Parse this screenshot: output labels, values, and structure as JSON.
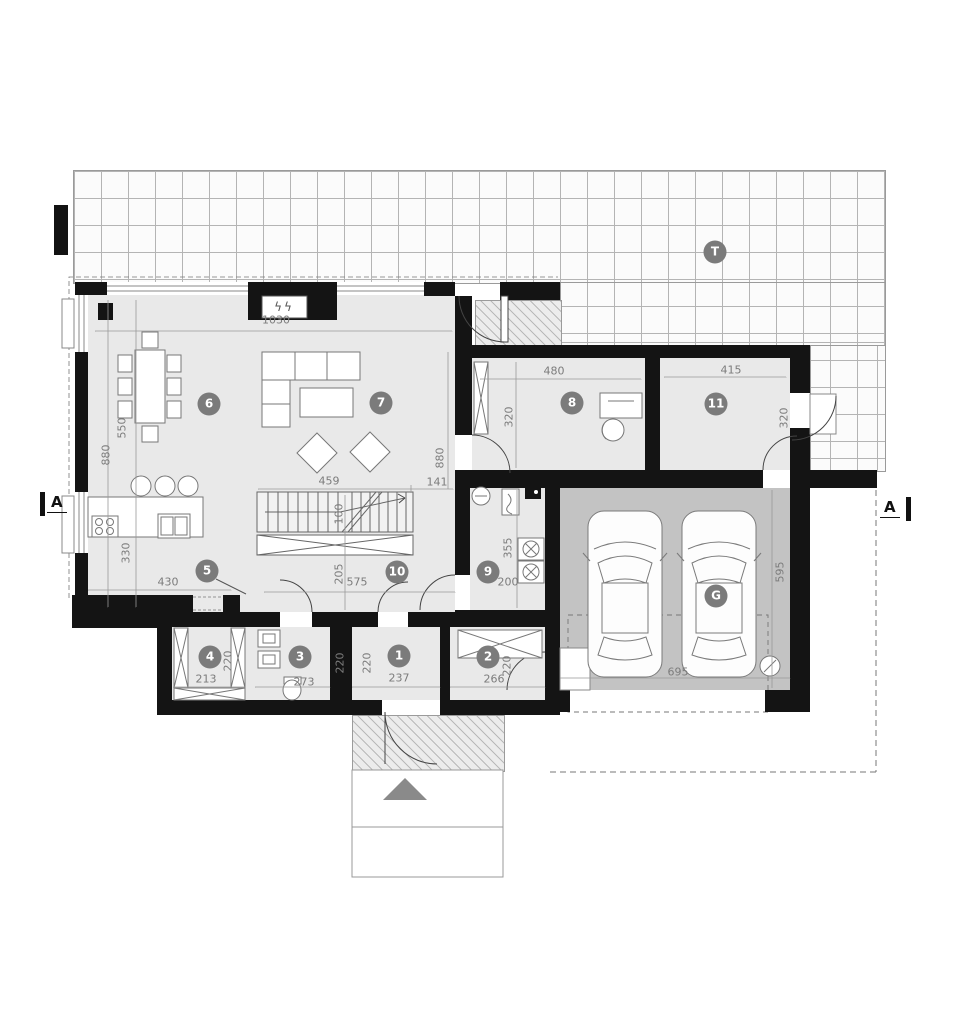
{
  "plan": {
    "section_marker": "A",
    "terrace_label": "T",
    "garage_label": "G",
    "fireplace_icon_glyph": "ϟϟ"
  },
  "rooms": [
    {
      "number": "1",
      "x": 399,
      "y": 656
    },
    {
      "number": "2",
      "x": 488,
      "y": 657
    },
    {
      "number": "3",
      "x": 300,
      "y": 657
    },
    {
      "number": "4",
      "x": 210,
      "y": 657
    },
    {
      "number": "5",
      "x": 207,
      "y": 571
    },
    {
      "number": "6",
      "x": 209,
      "y": 404
    },
    {
      "number": "7",
      "x": 381,
      "y": 403
    },
    {
      "number": "8",
      "x": 572,
      "y": 403
    },
    {
      "number": "9",
      "x": 488,
      "y": 572
    },
    {
      "number": "10",
      "x": 397,
      "y": 572
    },
    {
      "number": "11",
      "x": 716,
      "y": 404
    }
  ],
  "dimensions": [
    {
      "text": "1030",
      "x": 276,
      "y": 320,
      "rot": 0
    },
    {
      "text": "550",
      "x": 122,
      "y": 428,
      "rot": 1
    },
    {
      "text": "880",
      "x": 106,
      "y": 455,
      "rot": 1
    },
    {
      "text": "880",
      "x": 440,
      "y": 458,
      "rot": 1
    },
    {
      "text": "459",
      "x": 329,
      "y": 481,
      "rot": 0
    },
    {
      "text": "141",
      "x": 437,
      "y": 482,
      "rot": 0
    },
    {
      "text": "480",
      "x": 554,
      "y": 371,
      "rot": 0
    },
    {
      "text": "415",
      "x": 731,
      "y": 370,
      "rot": 0
    },
    {
      "text": "320",
      "x": 509,
      "y": 417,
      "rot": 1
    },
    {
      "text": "320",
      "x": 784,
      "y": 418,
      "rot": 1
    },
    {
      "text": "430",
      "x": 168,
      "y": 582,
      "rot": 0
    },
    {
      "text": "330",
      "x": 126,
      "y": 553,
      "rot": 1
    },
    {
      "text": "100",
      "x": 339,
      "y": 514,
      "rot": 1
    },
    {
      "text": "205",
      "x": 339,
      "y": 574,
      "rot": 1
    },
    {
      "text": "575",
      "x": 357,
      "y": 582,
      "rot": 0
    },
    {
      "text": "355",
      "x": 508,
      "y": 548,
      "rot": 1
    },
    {
      "text": "200",
      "x": 508,
      "y": 582,
      "rot": 0
    },
    {
      "text": "213",
      "x": 206,
      "y": 679,
      "rot": 0
    },
    {
      "text": "220",
      "x": 228,
      "y": 661,
      "rot": 1
    },
    {
      "text": "273",
      "x": 304,
      "y": 682,
      "rot": 0
    },
    {
      "text": "220",
      "x": 340,
      "y": 663,
      "rot": 1
    },
    {
      "text": "237",
      "x": 399,
      "y": 678,
      "rot": 0
    },
    {
      "text": "220",
      "x": 367,
      "y": 663,
      "rot": 1
    },
    {
      "text": "266",
      "x": 494,
      "y": 679,
      "rot": 0
    },
    {
      "text": "220",
      "x": 507,
      "y": 666,
      "rot": 1
    },
    {
      "text": "695",
      "x": 678,
      "y": 672,
      "rot": 0
    },
    {
      "text": "595",
      "x": 780,
      "y": 572,
      "rot": 1
    }
  ]
}
